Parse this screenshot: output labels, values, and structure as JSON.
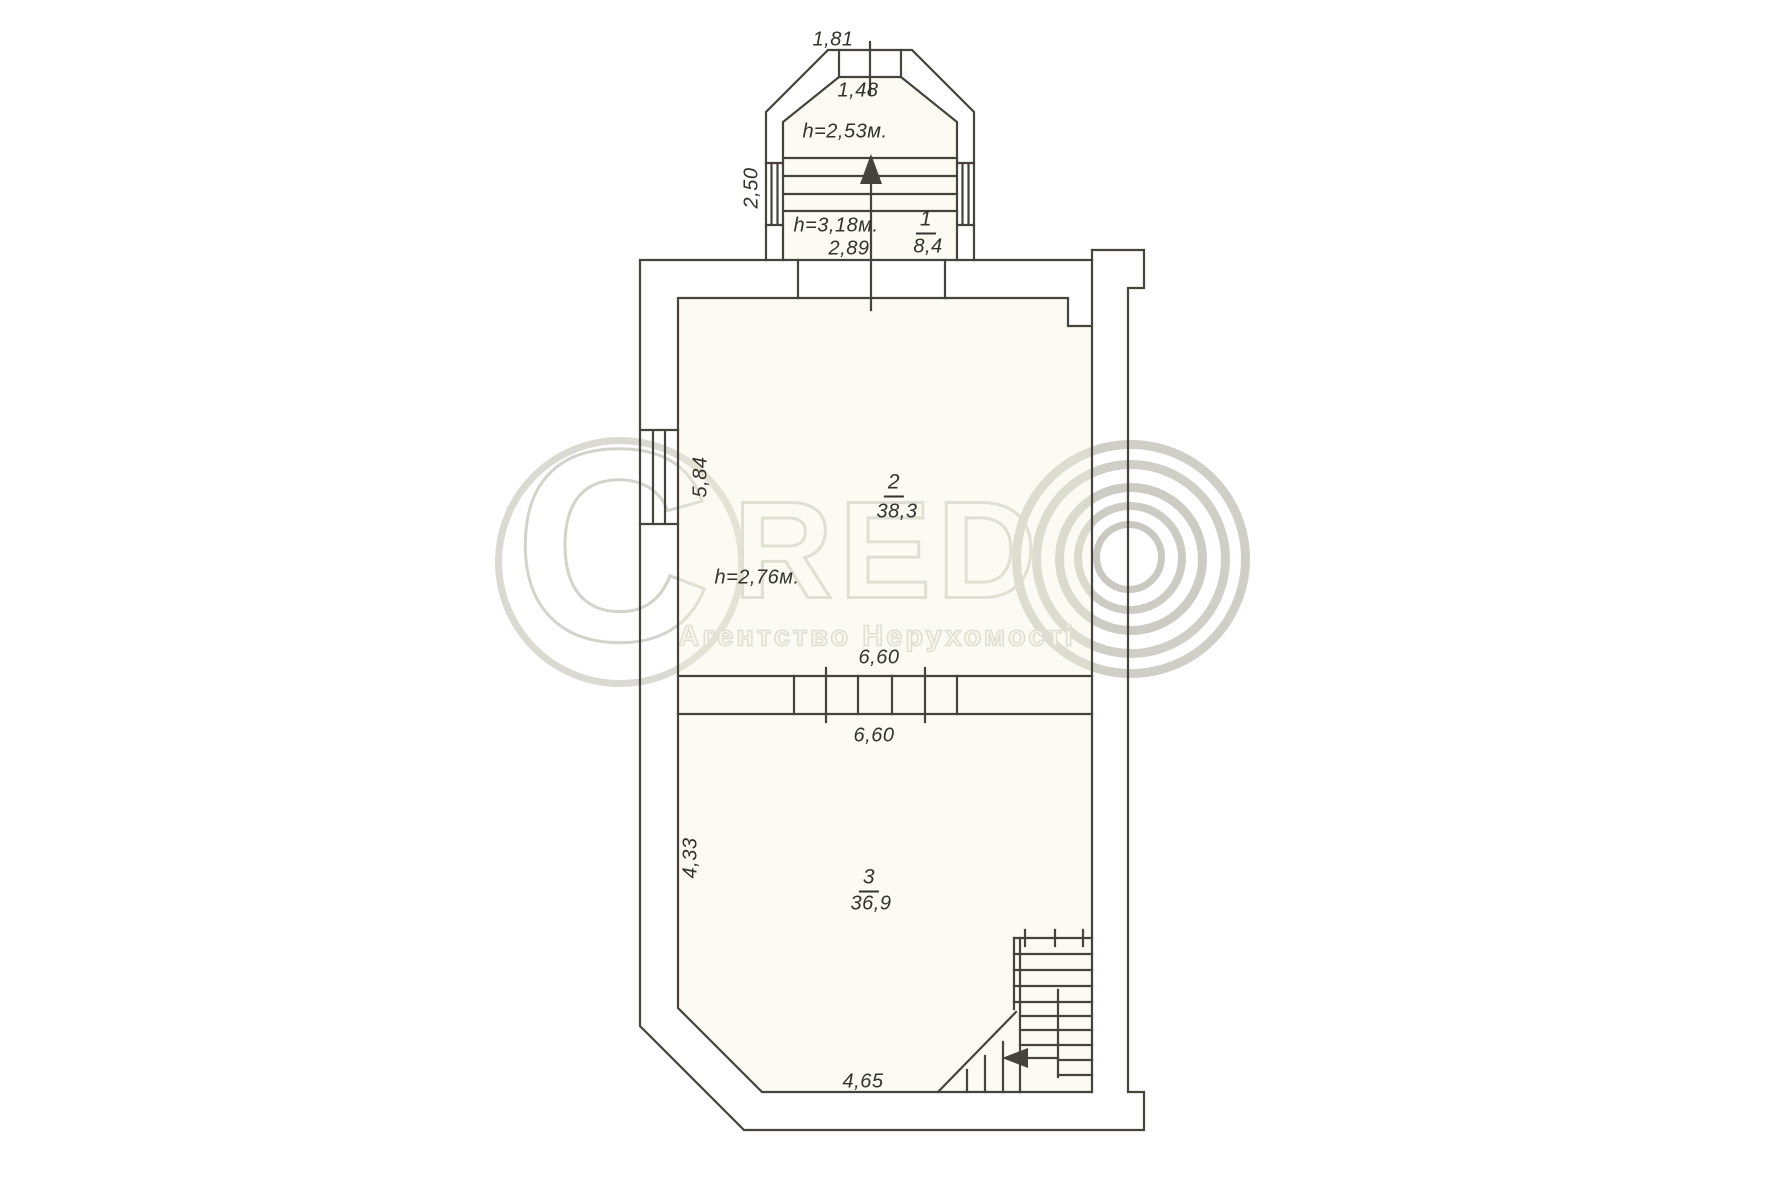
{
  "page": {
    "background": "#ffffff",
    "type": "scanned floor plan"
  },
  "watermark": {
    "brand_c": "C",
    "brand_red": "RED",
    "logo": "copyright-concentric-circles",
    "subtitle": "Агентство Нерухомості",
    "color": "#d3d3cc"
  },
  "plan": {
    "line_color": "#45433c",
    "rooms": [
      {
        "number": "1",
        "area": "8,4",
        "height_notes": [
          "h=2,53м.",
          "h=3,18м."
        ],
        "widths": [
          "1,81",
          "1,48",
          "2,89"
        ],
        "side_depth": "2,50"
      },
      {
        "number": "2",
        "area": "38,3",
        "height_note": "h=2,76м.",
        "width": "6,60",
        "depth": "5,84"
      },
      {
        "number": "3",
        "area": "36,9",
        "width": "6,60",
        "bottom_width": "4,65",
        "depth": "4,33"
      }
    ],
    "labels": {
      "bay_width_outer": "1,81",
      "bay_width_inner": "1,48",
      "bay_height_note": "h=2,53м.",
      "bay_side_depth": "2,50",
      "room1_height_note": "h=3,18м.",
      "room1_number": "1",
      "room1_area": "8,4",
      "room1_width": "2,89",
      "room2_depth": "5,84",
      "room2_number": "2",
      "room2_area": "38,3",
      "room2_height_note": "h=2,76м.",
      "room2_width": "6,60",
      "room3_width": "6,60",
      "room3_depth": "4,33",
      "room3_number": "3",
      "room3_area": "36,9",
      "room3_bottom_width": "4,65"
    }
  }
}
